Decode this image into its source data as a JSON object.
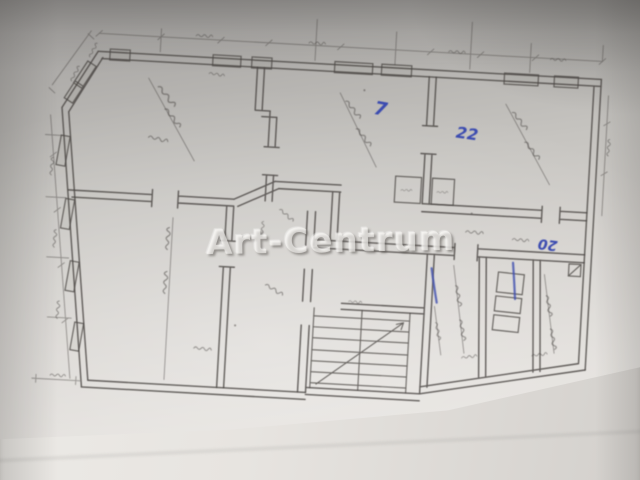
{
  "photo": {
    "description": "Blurry photograph of a hand-drawn architectural floor plan on folded paper",
    "watermark_text": "Art-Centrum"
  },
  "annotations": {
    "blue_ink_numbers": [
      {
        "text": "7",
        "location": "top-middle room"
      },
      {
        "text": "22",
        "location": "top-right room"
      },
      {
        "text": "20",
        "location": "right corridor, written upside down"
      }
    ]
  },
  "palette": {
    "paper_shadow": "#9e9c9a",
    "paper_mid": "#c9c6c2",
    "paper_bright": "#e9e6e2",
    "pencil_line": "#4a4643",
    "blue_ink": "#3b4bb0",
    "watermark_white": "rgba(253,252,249,0.60)"
  }
}
